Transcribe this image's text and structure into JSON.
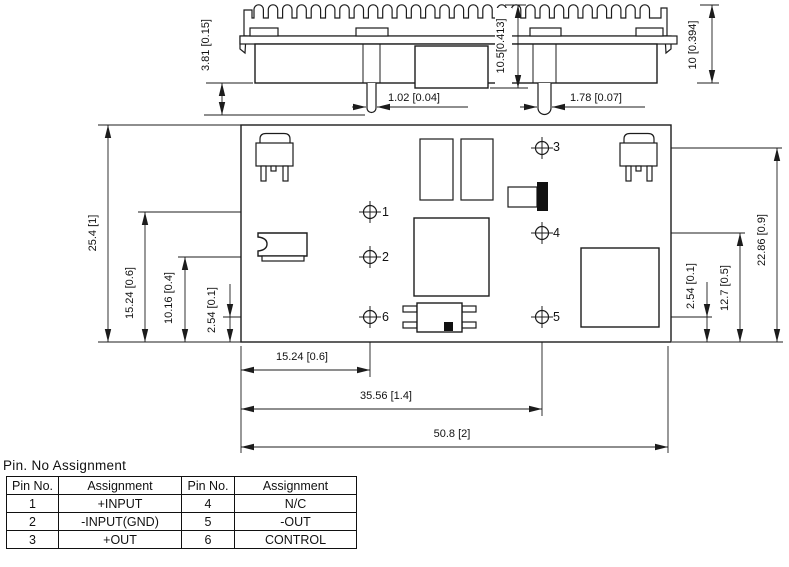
{
  "side_view": {
    "dim_standoff": "3.81 [0.15]",
    "dim_total_height": "10.5[0.413]",
    "dim_case_height": "10 [0.394]",
    "dim_pin_small_dia": "1.02 [0.04]",
    "dim_pin_large_dia": "1.78 [0.07]"
  },
  "bottom_view": {
    "dim_left_full_height": "25.4 [1]",
    "dim_left_pin1_row": "15.24 [0.6]",
    "dim_left_pin2_row": "10.16 [0.4]",
    "dim_left_pin6_row": "2.54 [0.1]",
    "dim_right_pin3_row": "22.86 [0.9]",
    "dim_right_pin4_row": "12.7 [0.5]",
    "dim_right_pin5_row": "2.54 [0.1]",
    "dim_bottom_col1": "15.24 [0.6]",
    "dim_bottom_col2": "35.56 [1.4]",
    "dim_bottom_full_width": "50.8 [2]",
    "pins": {
      "p1": "1",
      "p2": "2",
      "p3": "3",
      "p4": "4",
      "p5": "5",
      "p6": "6"
    }
  },
  "pin_table": {
    "title": "Pin. No Assignment",
    "headers": [
      "Pin No.",
      "Assignment",
      "Pin No.",
      "Assignment"
    ],
    "rows": [
      [
        "1",
        "+INPUT",
        "4",
        "N/C"
      ],
      [
        "2",
        "-INPUT(GND)",
        "5",
        "-OUT"
      ],
      [
        "3",
        "+OUT",
        "6",
        "CONTROL"
      ]
    ]
  },
  "colors": {
    "line": "#1c1c1c",
    "background": "#ffffff"
  }
}
